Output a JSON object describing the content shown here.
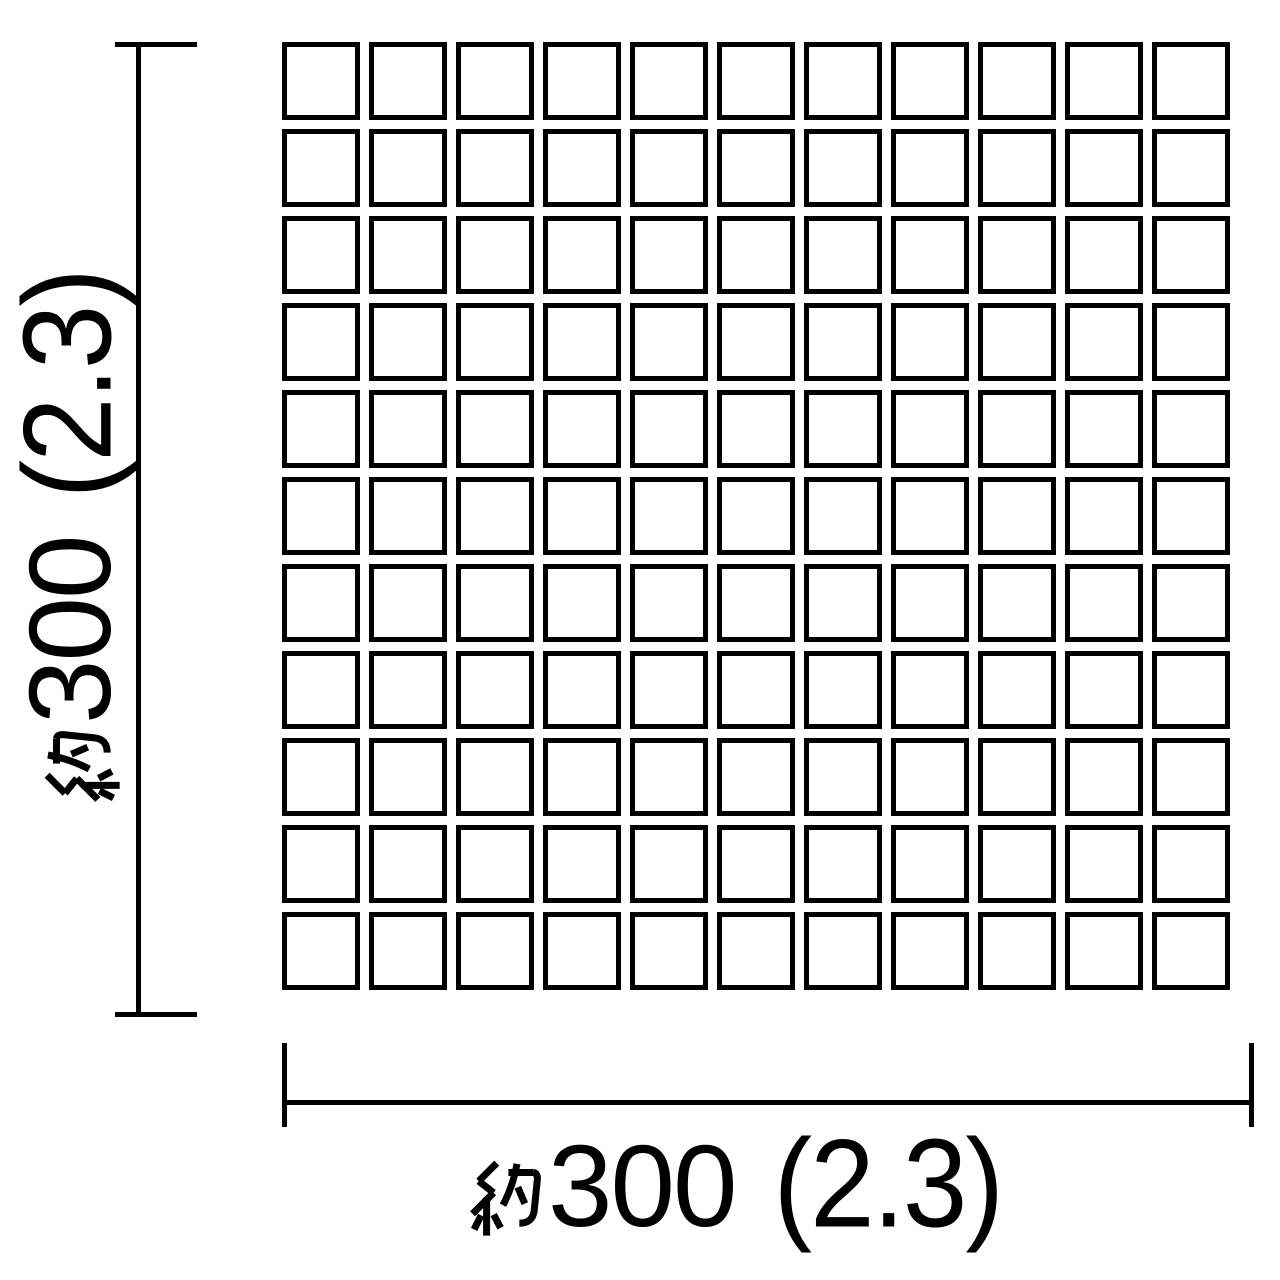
{
  "page": {
    "background": "#ffffff",
    "description_not_rendered": ""
  },
  "grid": {
    "rows": 11,
    "cols": 11,
    "tile_count": 121
  },
  "dimension_vertical": {
    "label_full": "約300（2.3）",
    "kanji_prefix": "約",
    "value": "300",
    "parenthetical": "(2.3)"
  },
  "dimension_horizontal": {
    "label_full": "約300（2.3）",
    "kanji_prefix": "約",
    "value": "300",
    "parenthetical": "(2.3)"
  },
  "colors": {
    "ink": "#000000",
    "background": "#ffffff",
    "tile_fill": "#ffffff"
  }
}
